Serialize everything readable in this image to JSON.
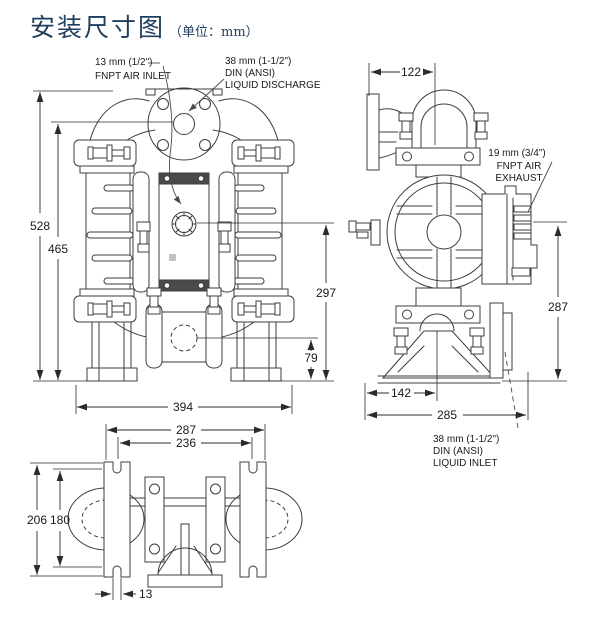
{
  "title": {
    "text": "安装尺寸图",
    "unit": "（单位：mm）"
  },
  "colors": {
    "title": "#1f3d5c",
    "line": "#3d3d3d",
    "dimension_text": "#1a1a1a"
  },
  "port_labels": {
    "air_inlet_size": "13 mm (1/2\")",
    "air_inlet_name": "FNPT AIR INLET",
    "discharge_size": "38 mm (1-1/2\")",
    "discharge_std": "DIN (ANSI)",
    "discharge_name": "LIQUID DISCHARGE",
    "exhaust_size": "19 mm (3/4\")",
    "exhaust_name1": "FNPT AIR",
    "exhaust_name2": "EXHAUST",
    "inlet_size": "38 mm (1-1/2\")",
    "inlet_std": "DIN (ANSI)",
    "inlet_name": "LIQUID INLET"
  },
  "dims": {
    "front": {
      "overall_height": "528",
      "port_height": "465",
      "inlet_center_height": "297",
      "foot_center_height": "79",
      "overall_width": "394"
    },
    "side": {
      "top_width": "122",
      "right_height": "287",
      "base_center_width": "142",
      "base_width": "285"
    },
    "bottom": {
      "outer_width": "287",
      "slot_span": "236",
      "depth": "206",
      "inner_depth": "180",
      "slot_width": "13"
    }
  }
}
